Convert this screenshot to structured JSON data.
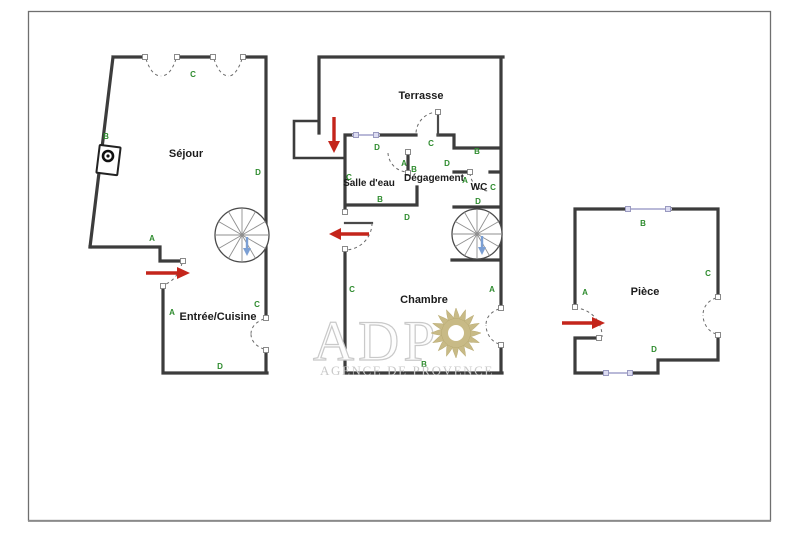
{
  "page": {
    "background": "#ffffff",
    "frame_color": "#6f6f6f"
  },
  "watermark": {
    "brand": "ADP",
    "tagline": "AGENCE DE PROVENCE",
    "sun_color": "#c8ba86",
    "text_color": "#c9c9c9"
  },
  "colors": {
    "wall": "#3c3c3c",
    "letter_green": "#2e8b2e",
    "arrow_red": "#c4251b",
    "stair_arrow_blue": "#7b9fd4",
    "window_accent": "#dcdcf2"
  },
  "symbols": {
    "entry_arrow": "red-entry-arrow",
    "staircase": "spiral-staircase",
    "stair_direction": "blue-down-arrow",
    "door_swing": "dashed-door-arc",
    "window": "window-with-jamb-squares"
  },
  "plan": {
    "unit_left": {
      "rooms": {
        "sejour": "Séjour",
        "entree_cuisine": "Entrée/Cuisine"
      },
      "letters": {
        "top": "C",
        "side": "B",
        "sejour_right": "D",
        "step": "A",
        "entry_side": "A",
        "window": "C",
        "bottom": "D"
      }
    },
    "unit_middle": {
      "rooms": {
        "terrasse": "Terrasse",
        "salle_deau": "Salle d'eau",
        "degagement": "Dégagement",
        "wc": "WC",
        "chambre": "Chambre"
      },
      "letters": {
        "sde_window": "D",
        "sde_left": "C",
        "sde_door_a": "A",
        "sde_door_b": "B",
        "deg_door": "C",
        "deg_d": "D",
        "deg_wc": "A",
        "wc_top": "B",
        "wc_right": "C",
        "wc_bottom": "D",
        "sde_bottom": "B",
        "ch_top": "D",
        "ch_left": "C",
        "ch_right": "A",
        "ch_bottom": "B"
      }
    },
    "unit_right": {
      "rooms": {
        "piece": "Pièce"
      },
      "letters": {
        "top": "B",
        "left": "A",
        "right": "C",
        "bottom": "D"
      }
    }
  }
}
